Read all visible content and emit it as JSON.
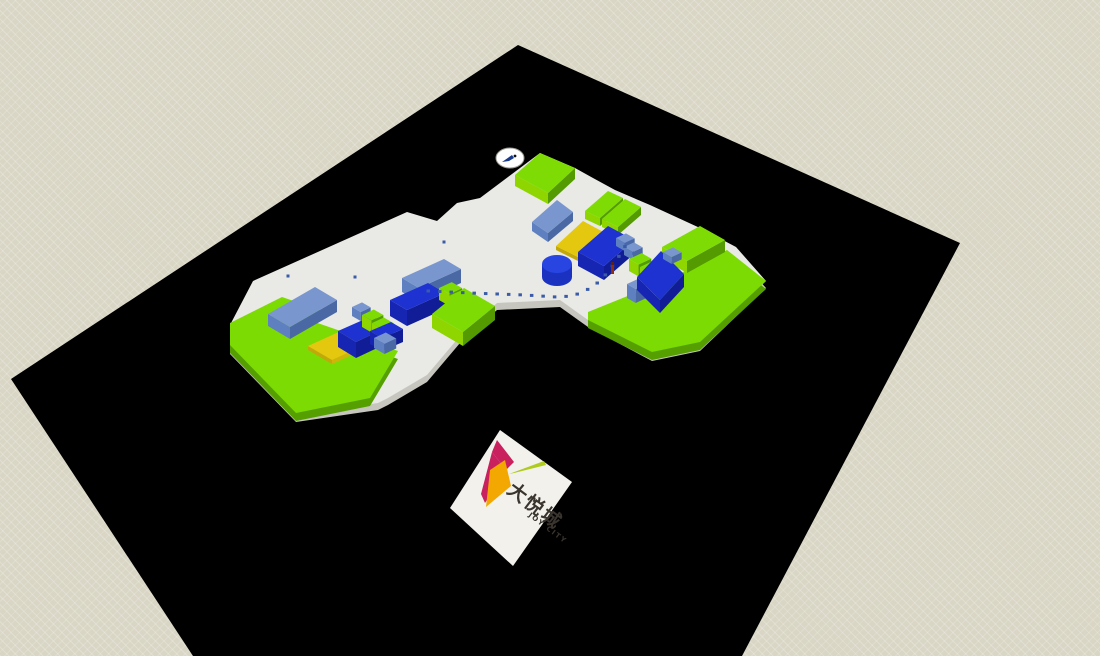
{
  "viewport": {
    "description": "3D massing model viewport of Joy City mall site",
    "width": 1100,
    "height": 656
  },
  "logo": {
    "chinese": "大悦城",
    "english": "JOY CITY"
  },
  "palette": {
    "background": "#D9D6C5",
    "ground": "#000000",
    "plaza_top": "#E9E9E5",
    "plaza_side": "#C6C6BE",
    "platform": {
      "top": "#7CDB02",
      "side": "#55A000"
    },
    "colors": {
      "green": {
        "top": "#7EDC04",
        "front": "#8FD500",
        "side": "#539B00"
      },
      "steelblue": {
        "top": "#7997CE",
        "front": "#5F80C0",
        "side": "#4A69A4"
      },
      "darkblue": {
        "top": "#1D32D0",
        "front": "#1726B2",
        "side": "#111D96"
      },
      "yellow": {
        "top": "#E4C80F",
        "front": "#C2A80A",
        "side": "#D0B40C"
      }
    },
    "dot": "#3A5CA8",
    "cylinder": {
      "top": "#2845E2",
      "side": "#1B32C0"
    },
    "figure": {
      "body": "#8B2F10",
      "head": "#60200A"
    },
    "cursor": {
      "fill": "#FFFFFF",
      "stroke": "#9A9A92",
      "arrow": "#1A3A8C",
      "dot": "#111111"
    },
    "logo_board": "#F2F1EC",
    "logo_mark": {
      "magenta": "#C9215E",
      "orange": "#F2A800",
      "leaf": "#AFCB1C"
    },
    "logo_text": "#3A342E"
  },
  "scene": {
    "projection": {
      "v": [
        0.908,
        -0.419
      ],
      "u": [
        0.868,
        0.497
      ]
    },
    "ground": [
      [
        518,
        45
      ],
      [
        960,
        243
      ],
      [
        742,
        656
      ],
      [
        193,
        656
      ],
      [
        11,
        379
      ]
    ],
    "plaza": [
      [
        230,
        325
      ],
      [
        253,
        281
      ],
      [
        407,
        212
      ],
      [
        437,
        221
      ],
      [
        457,
        203
      ],
      [
        480,
        198
      ],
      [
        540,
        153
      ],
      [
        575,
        168
      ],
      [
        593,
        178
      ],
      [
        615,
        190
      ],
      [
        650,
        205
      ],
      [
        700,
        228
      ],
      [
        736,
        247
      ],
      [
        766,
        281
      ],
      [
        700,
        344
      ],
      [
        652,
        354
      ],
      [
        588,
        320
      ],
      [
        560,
        300
      ],
      [
        497,
        303
      ],
      [
        460,
        336
      ],
      [
        427,
        375
      ],
      [
        388,
        398
      ],
      [
        378,
        403
      ],
      [
        296,
        415
      ],
      [
        230,
        347
      ]
    ],
    "platforms": [
      {
        "name": "platform-left-wing",
        "points": [
          [
            230,
            323
          ],
          [
            282,
            297
          ],
          [
            320,
            310
          ],
          [
            306,
            319
          ],
          [
            398,
            351
          ],
          [
            370,
            398
          ],
          [
            296,
            413
          ],
          [
            230,
            345
          ]
        ]
      },
      {
        "name": "platform-right-wing",
        "points": [
          [
            588,
            312
          ],
          [
            640,
            291
          ],
          [
            655,
            297
          ],
          [
            683,
            272
          ],
          [
            727,
            250
          ],
          [
            766,
            281
          ],
          [
            700,
            342
          ],
          [
            652,
            352
          ],
          [
            588,
            320
          ]
        ]
      }
    ],
    "blocks": [
      {
        "q": [
          [
            515,
            175
          ],
          [
            540,
            153
          ],
          [
            575,
            168
          ],
          [
            548,
            193
          ]
        ],
        "h": 11,
        "c": "green"
      },
      {
        "q": [
          [
            585,
            211
          ],
          [
            608,
            191
          ],
          [
            623,
            198
          ],
          [
            600,
            218
          ]
        ],
        "h": 8,
        "c": "green"
      },
      {
        "q": [
          [
            602,
            219
          ],
          [
            625,
            199
          ],
          [
            641,
            207
          ],
          [
            618,
            227
          ]
        ],
        "h": 8,
        "c": "green"
      },
      {
        "q": [
          [
            532,
            222
          ],
          [
            557,
            200
          ],
          [
            573,
            212
          ],
          [
            548,
            233
          ]
        ],
        "h": 9,
        "c": "steelblue"
      },
      {
        "q": [
          [
            556,
            246
          ],
          [
            583,
            221
          ],
          [
            607,
            234
          ],
          [
            580,
            258
          ]
        ],
        "h": 4,
        "c": "yellow"
      },
      {
        "q": [
          [
            578,
            252
          ],
          [
            608,
            226
          ],
          [
            634,
            240
          ],
          [
            604,
            266
          ]
        ],
        "h": 14,
        "c": "darkblue"
      },
      {
        "f": [
          616,
          238
        ],
        "w": 11,
        "d": 10,
        "h": 8,
        "c": "steelblue"
      },
      {
        "f": [
          624,
          247
        ],
        "w": 11,
        "d": 10,
        "h": 8,
        "c": "steelblue"
      },
      {
        "q": [
          [
            268,
            314
          ],
          [
            315,
            287
          ],
          [
            337,
            300
          ],
          [
            290,
            327
          ]
        ],
        "h": 12,
        "c": "steelblue"
      },
      {
        "q": [
          [
            308,
            346
          ],
          [
            352,
            326
          ],
          [
            376,
            340
          ],
          [
            332,
            360
          ]
        ],
        "h": 4,
        "c": "yellow"
      },
      {
        "q": [
          [
            338,
            331
          ],
          [
            372,
            316
          ],
          [
            390,
            326
          ],
          [
            356,
            342
          ]
        ],
        "h": 16,
        "c": "darkblue"
      },
      {
        "f": [
          352,
          307
        ],
        "w": 11,
        "d": 10,
        "h": 9,
        "c": "steelblue"
      },
      {
        "f": [
          362,
          315
        ],
        "w": 13,
        "d": 11,
        "h": 12,
        "c": "green"
      },
      {
        "f": [
          372,
          323
        ],
        "w": 13,
        "d": 11,
        "h": 11,
        "c": "green"
      },
      {
        "q": [
          [
            370,
            331
          ],
          [
            391,
            322
          ],
          [
            403,
            329
          ],
          [
            382,
            338
          ]
        ],
        "h": 13,
        "c": "darkblue"
      },
      {
        "f": [
          374,
          338
        ],
        "w": 13,
        "d": 12,
        "h": 10,
        "c": "steelblue"
      },
      {
        "q": [
          [
            402,
            278
          ],
          [
            444,
            259
          ],
          [
            461,
            269
          ],
          [
            419,
            288
          ]
        ],
        "h": 14,
        "c": "steelblue"
      },
      {
        "q": [
          [
            390,
            300
          ],
          [
            428,
            283
          ],
          [
            445,
            293
          ],
          [
            407,
            310
          ]
        ],
        "h": 16,
        "c": "darkblue"
      },
      {
        "f": [
          439,
          288
        ],
        "w": 14,
        "d": 12,
        "h": 12,
        "c": "green"
      },
      {
        "f": [
          449,
          296
        ],
        "w": 13,
        "d": 11,
        "h": 11,
        "c": "green"
      },
      {
        "f": [
          458,
          306
        ],
        "w": 12,
        "d": 11,
        "h": 9,
        "c": "steelblue"
      },
      {
        "q": [
          [
            432,
            314
          ],
          [
            464,
            288
          ],
          [
            495,
            306
          ],
          [
            463,
            332
          ]
        ],
        "h": 14,
        "c": "green"
      },
      {
        "q": [
          [
            662,
            247
          ],
          [
            700,
            226
          ],
          [
            725,
            240
          ],
          [
            687,
            261
          ]
        ],
        "h": 12,
        "c": "green"
      },
      {
        "f": [
          629,
          259
        ],
        "w": 14,
        "d": 11,
        "h": 12,
        "c": "green"
      },
      {
        "f": [
          640,
          267
        ],
        "w": 14,
        "d": 11,
        "h": 12,
        "c": "green"
      },
      {
        "f": [
          627,
          284
        ],
        "w": 11,
        "d": 10,
        "h": 14,
        "c": "steelblue"
      },
      {
        "q": [
          [
            637,
            277
          ],
          [
            661,
            251
          ],
          [
            684,
            274
          ],
          [
            660,
            300
          ]
        ],
        "h": 13,
        "c": "darkblue"
      },
      {
        "f": [
          663,
          252
        ],
        "w": 11,
        "d": 10,
        "h": 7,
        "c": "steelblue"
      }
    ],
    "cylinder": {
      "c": [
        557,
        264
      ],
      "rx": 15,
      "ry": 9,
      "h": 13
    },
    "path_dots": {
      "polyline": [
        [
          428,
          291
        ],
        [
          470,
          293
        ],
        [
          525,
          295
        ],
        [
          556,
          297
        ],
        [
          572,
          296
        ],
        [
          585,
          291
        ],
        [
          597,
          283
        ],
        [
          607,
          273
        ],
        [
          615,
          262
        ],
        [
          622,
          251
        ],
        [
          628,
          241
        ]
      ],
      "spacing": 11.5,
      "size": 3,
      "extra": [
        [
          288,
          276
        ],
        [
          355,
          277
        ],
        [
          444,
          242
        ]
      ]
    },
    "figure": {
      "x": 611,
      "y": 262
    },
    "cursor": {
      "cx": 510,
      "cy": 158,
      "rx": 14,
      "ry": 10
    },
    "logo_board": {
      "diamond": [
        [
          500,
          430
        ],
        [
          572,
          482
        ],
        [
          513,
          566
        ],
        [
          450,
          508
        ]
      ],
      "mark": {
        "magenta1": [
          [
            497,
            440
          ],
          [
            514,
            462
          ],
          [
            506,
            470
          ],
          [
            492,
            452
          ]
        ],
        "magenta2": [
          [
            492,
            452
          ],
          [
            506,
            470
          ],
          [
            485,
            503
          ],
          [
            481,
            494
          ]
        ],
        "orange": [
          [
            505,
            460
          ],
          [
            511,
            486
          ],
          [
            486,
            507
          ],
          [
            490,
            470
          ]
        ],
        "leaf": [
          [
            509,
            474
          ],
          [
            544,
            461
          ],
          [
            546,
            465
          ],
          [
            514,
            473
          ]
        ]
      }
    }
  }
}
